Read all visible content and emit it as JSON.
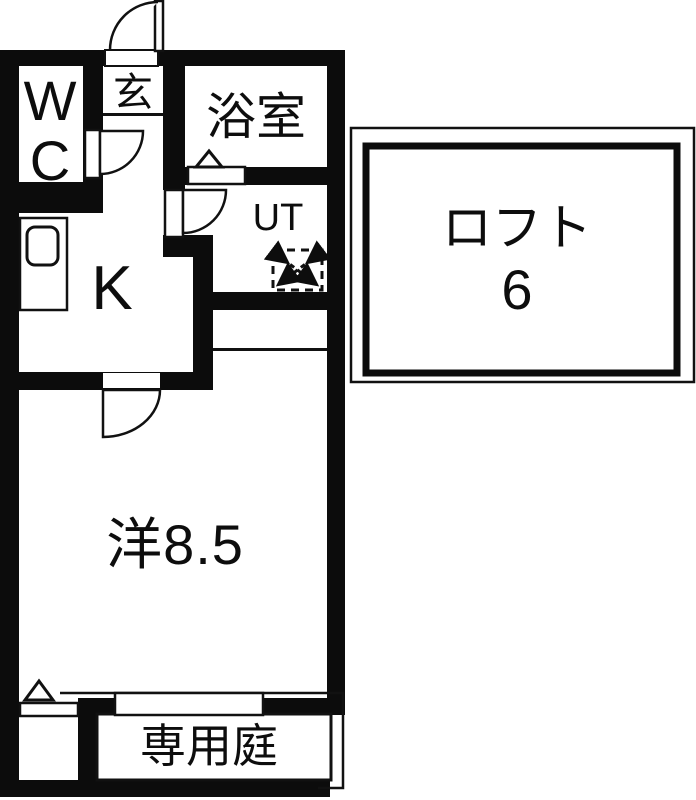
{
  "floorplan": {
    "type": "japanese-apartment-floor-plan",
    "rooms": {
      "wc": {
        "label_line1": "W",
        "label_line2": "C"
      },
      "entrance": {
        "label": "玄"
      },
      "bathroom": {
        "label": "浴室"
      },
      "utility": {
        "label": "UT"
      },
      "kitchen": {
        "label": "K"
      },
      "loft": {
        "label": "ロフト",
        "size": "6"
      },
      "western_room": {
        "label": "洋8.5"
      },
      "garden": {
        "label": "専用庭"
      }
    },
    "colors": {
      "wall": "#0c0c0c",
      "floor": "#ffffff",
      "line": "#111111"
    }
  }
}
